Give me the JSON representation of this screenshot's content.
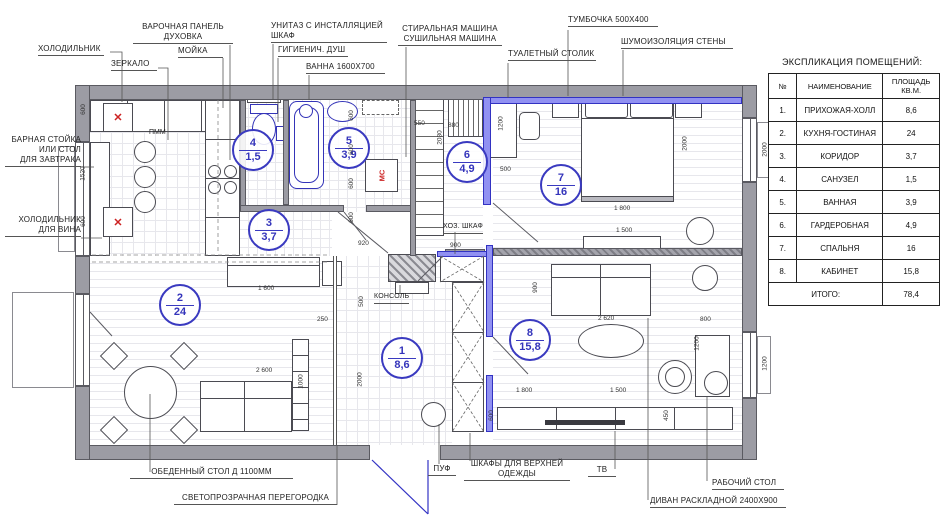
{
  "colors": {
    "wall": "#9c9ca4",
    "soundproof_fill": "#9191f2",
    "soundproof_border": "#3232c2",
    "room_circle": "#3a3ac0",
    "accent_red": "#cc2222"
  },
  "legend": {
    "title": "ЭКСПЛИКАЦИЯ ПОМЕЩЕНИЙ:",
    "headers": {
      "num": "№",
      "name": "НАИМЕНОВАНИЕ",
      "area": "ПЛОЩАДЬ КВ.М."
    },
    "rows": [
      {
        "num": "1.",
        "name": "ПРИХОЖАЯ-ХОЛЛ",
        "area": "8,6"
      },
      {
        "num": "2.",
        "name": "КУХНЯ-ГОСТИНАЯ",
        "area": "24"
      },
      {
        "num": "3.",
        "name": "КОРИДОР",
        "area": "3,7"
      },
      {
        "num": "4.",
        "name": "САНУЗЕЛ",
        "area": "1,5"
      },
      {
        "num": "5.",
        "name": "ВАННАЯ",
        "area": "3,9"
      },
      {
        "num": "6.",
        "name": "ГАРДЕРОБНАЯ",
        "area": "4,9"
      },
      {
        "num": "7.",
        "name": "СПАЛЬНЯ",
        "area": "16"
      },
      {
        "num": "8.",
        "name": "КАБИНЕТ",
        "area": "15,8"
      }
    ],
    "total_label": "ИТОГО:",
    "total_value": "78,4"
  },
  "callouts": {
    "fridge": "ХОЛОДИЛЬНИК",
    "mirror": "ЗЕРКАЛО",
    "hob": "ВАРОЧНАЯ ПАНЕЛЬ",
    "oven": "ДУХОВКА",
    "sink": "МОЙКА",
    "toilet1": "УНИТАЗ С ИНСТАЛЛЯЦИЕЙ",
    "toilet2": "ШКАФ",
    "shower": "ГИГИЕНИЧ. ДУШ",
    "bath": "ВАННА 1600Х700",
    "washer": "СТИРАЛЬНАЯ МАШИНА",
    "dryer": "СУШИЛЬНАЯ МАШИНА",
    "dressing": "ТУАЛЕТНЫЙ СТОЛИК",
    "nightstand": "ТУМБОЧКА 500Х400",
    "soundproof": "ШУМОИЗОЛЯЦИЯ СТЕНЫ",
    "bar1": "БАРНАЯ СТОЙКА",
    "bar2": "ИЛИ СТОЛ",
    "bar3": "ДЛЯ ЗАВТРАКА",
    "wine1": "ХОЛОДИЛЬНИК",
    "wine2": "ДЛЯ ВИНА",
    "dining": "ОБЕДЕННЫЙ СТОЛ Д 1100ММ",
    "partition": "СВЕТОПРОЗРАЧНАЯ ПЕРЕГОРОДКА",
    "pouf": "ПУФ",
    "closet1": "ШКАФЫ ДЛЯ ВЕРХНЕЙ",
    "closet2": "ОДЕЖДЫ",
    "tv": "ТВ",
    "sofa": "ДИВАН РАСКЛАДНОЙ 2400Х900",
    "desk": "РАБОЧИЙ СТОЛ"
  },
  "plan_labels": {
    "pmm": "ПММ",
    "hoz": "ХОЗ. ШКАФ",
    "konsol": "КОНСОЛЬ",
    "ms": "МС",
    "x_mark": "✕"
  },
  "rooms": [
    {
      "num": "1",
      "area": "8,6",
      "x": 400,
      "y": 356
    },
    {
      "num": "2",
      "area": "24",
      "x": 178,
      "y": 303
    },
    {
      "num": "3",
      "area": "3,7",
      "x": 267,
      "y": 228
    },
    {
      "num": "4",
      "area": "1,5",
      "x": 251,
      "y": 148
    },
    {
      "num": "5",
      "area": "3,9",
      "x": 347,
      "y": 146
    },
    {
      "num": "6",
      "area": "4,9",
      "x": 465,
      "y": 160
    },
    {
      "num": "7",
      "area": "16",
      "x": 559,
      "y": 183
    },
    {
      "num": "8",
      "area": "15,8",
      "x": 528,
      "y": 338
    }
  ],
  "dims": [
    {
      "t": "600",
      "x": 78,
      "y": 106,
      "r": 1
    },
    {
      "t": "1520",
      "x": 76,
      "y": 170,
      "r": 1
    },
    {
      "t": "600",
      "x": 78,
      "y": 218,
      "r": 1
    },
    {
      "t": "600",
      "x": 346,
      "y": 112,
      "r": 1
    },
    {
      "t": "600",
      "x": 346,
      "y": 146,
      "r": 1
    },
    {
      "t": "600",
      "x": 346,
      "y": 180,
      "r": 1
    },
    {
      "t": "600",
      "x": 346,
      "y": 214,
      "r": 1
    },
    {
      "t": "920",
      "x": 358,
      "y": 240
    },
    {
      "t": "900",
      "x": 450,
      "y": 242
    },
    {
      "t": "500",
      "x": 356,
      "y": 298,
      "r": 1
    },
    {
      "t": "2000",
      "x": 353,
      "y": 376,
      "r": 1
    },
    {
      "t": "250",
      "x": 317,
      "y": 316
    },
    {
      "t": "1 600",
      "x": 258,
      "y": 285
    },
    {
      "t": "2 600",
      "x": 256,
      "y": 367
    },
    {
      "t": "1000",
      "x": 294,
      "y": 378,
      "r": 1
    },
    {
      "t": "550",
      "x": 414,
      "y": 120
    },
    {
      "t": "880",
      "x": 448,
      "y": 122
    },
    {
      "t": "2030",
      "x": 433,
      "y": 134,
      "r": 1
    },
    {
      "t": "1200",
      "x": 494,
      "y": 120,
      "r": 1
    },
    {
      "t": "500",
      "x": 500,
      "y": 166
    },
    {
      "t": "1 800",
      "x": 614,
      "y": 205
    },
    {
      "t": "2000",
      "x": 678,
      "y": 140,
      "r": 1
    },
    {
      "t": "1 500",
      "x": 616,
      "y": 227
    },
    {
      "t": "2 620",
      "x": 598,
      "y": 315
    },
    {
      "t": "900",
      "x": 530,
      "y": 284,
      "r": 1
    },
    {
      "t": "800",
      "x": 700,
      "y": 316
    },
    {
      "t": "1200",
      "x": 690,
      "y": 340,
      "r": 1
    },
    {
      "t": "450",
      "x": 661,
      "y": 412,
      "r": 1
    },
    {
      "t": "600",
      "x": 486,
      "y": 412,
      "r": 1
    },
    {
      "t": "1 800",
      "x": 516,
      "y": 387
    },
    {
      "t": "1 500",
      "x": 610,
      "y": 387
    },
    {
      "t": "2000",
      "x": 758,
      "y": 146,
      "r": 1
    },
    {
      "t": "1200",
      "x": 758,
      "y": 360,
      "r": 1
    }
  ]
}
